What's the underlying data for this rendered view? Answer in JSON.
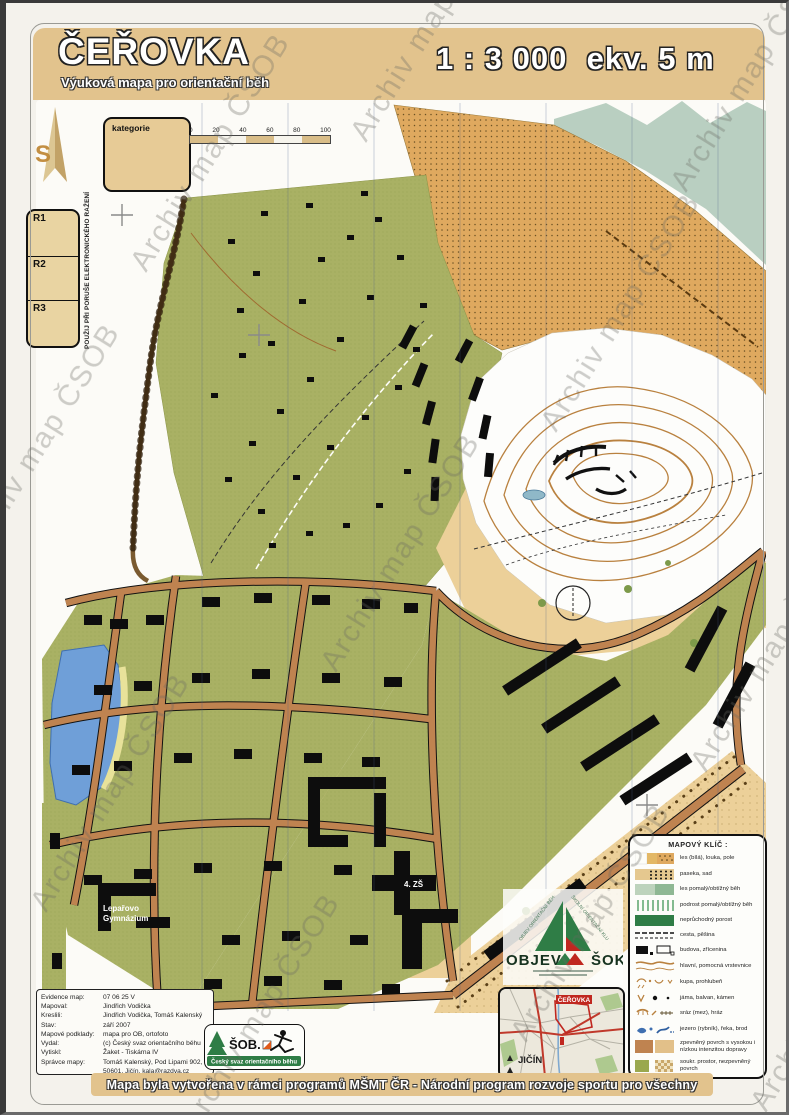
{
  "header": {
    "title": "ČEŘOVKA",
    "subtitle": "Výuková mapa pro orientační běh",
    "scale": "1 : 3 000",
    "equidistance": "ekv. 5 m"
  },
  "watermark": {
    "text": "Archiv map ČSOB"
  },
  "controls": {
    "north_label": "S",
    "kategorie_label": "kategorie",
    "r_boxes": [
      "R1",
      "R2",
      "R3"
    ],
    "vertical_note": "POUŽIJ PŘI PORUŠE ELEKTRONICKÉHO RAŽENÍ"
  },
  "scale_bar": {
    "ticks": [
      "0",
      "20",
      "40",
      "60",
      "80",
      "100"
    ]
  },
  "map_labels": {
    "gymnazium_line1": "Lepařovo",
    "gymnazium_line2": "Gymnázium",
    "school": "4. ZŠ"
  },
  "legend": {
    "title": "MAPOVÝ KLÍČ :",
    "items": [
      {
        "symbol": "forest-meadow-field",
        "label": "les (bílá), louka, pole"
      },
      {
        "symbol": "clearing-orchard",
        "label": "paseka, sad"
      },
      {
        "symbol": "slow-forest",
        "label": "les pomalý/obtížný běh"
      },
      {
        "symbol": "undergrowth",
        "label": "podrost pomalý/obtížný běh"
      },
      {
        "symbol": "impassable",
        "label": "neprůchodný porost"
      },
      {
        "symbol": "road-path",
        "label": "cesta, pěšina"
      },
      {
        "symbol": "building-ruin",
        "label": "budova, zřícenina"
      },
      {
        "symbol": "contours",
        "label": "hlavní, pomocná vrstevnice"
      },
      {
        "symbol": "knoll-depression",
        "label": "kupa, prohlubeň"
      },
      {
        "symbol": "pit-boulder-stone",
        "label": "jáma, balvan, kámen"
      },
      {
        "symbol": "earthbank-dam",
        "label": "sráz (mez), hráz"
      },
      {
        "symbol": "lake-river-ford",
        "label": "jezero (rybník), řeka, brod"
      },
      {
        "symbol": "paved-surface",
        "label": "zpevněný povrch s vysokou i nízkou intenzitou dopravy"
      },
      {
        "symbol": "private-unpaved",
        "label": "soukr. prostor, nezpevněný povrch"
      }
    ]
  },
  "imprint": {
    "rows": [
      {
        "label": "Evidence map:",
        "value": "07 06 25 V"
      },
      {
        "label": "Mapoval:",
        "value": "Jindřich Vodička"
      },
      {
        "label": "Kreslili:",
        "value": "Jindřich Vodička, Tomáš Kalenský"
      },
      {
        "label": "Stav:",
        "value": "září 2007"
      },
      {
        "label": "Mapové podklady:",
        "value": "mapa pro OB, ortofoto"
      },
      {
        "label": "Vydal:",
        "value": "(c) Český svaz orientačního běhu"
      },
      {
        "label": "Vytiskl:",
        "value": "Žaket - Tiskárna IV"
      },
      {
        "label": "Správce mapy:",
        "value": "Tomáš Kalenský, Pod Lipami 902, 50601, Jičín, kala@razdva.cz"
      }
    ]
  },
  "logos": {
    "sob": {
      "text": "ŠOB.",
      "caption": "Český svaz orientačního běhu"
    },
    "objev": {
      "left": "OBJEV",
      "right": "ŠOK",
      "arc_left": "OBJEV ORIENTAČNÍ BĚH",
      "arc_right": "ŠKOLNÍ ORIENTAČNÍ KLUBY"
    }
  },
  "inset": {
    "city": "JIČÍN",
    "area": "ČEŘOVKA"
  },
  "footer": {
    "banner": "Mapa byla vytvořena v rámci programů MŠMT ČR - Národní program rozvoje sportu pro všechny"
  },
  "colors": {
    "header_tan": "#e2c38d",
    "urban_green": "#a9b164",
    "field_orange": "#dfa95f",
    "street_brown": "#bf8350",
    "open_tan": "#ecd099",
    "slow_forest": "#b9cfc1",
    "impassable_green": "#2f7d46",
    "water_blue": "#6f9fd8",
    "contour_brown": "#b9813f"
  }
}
